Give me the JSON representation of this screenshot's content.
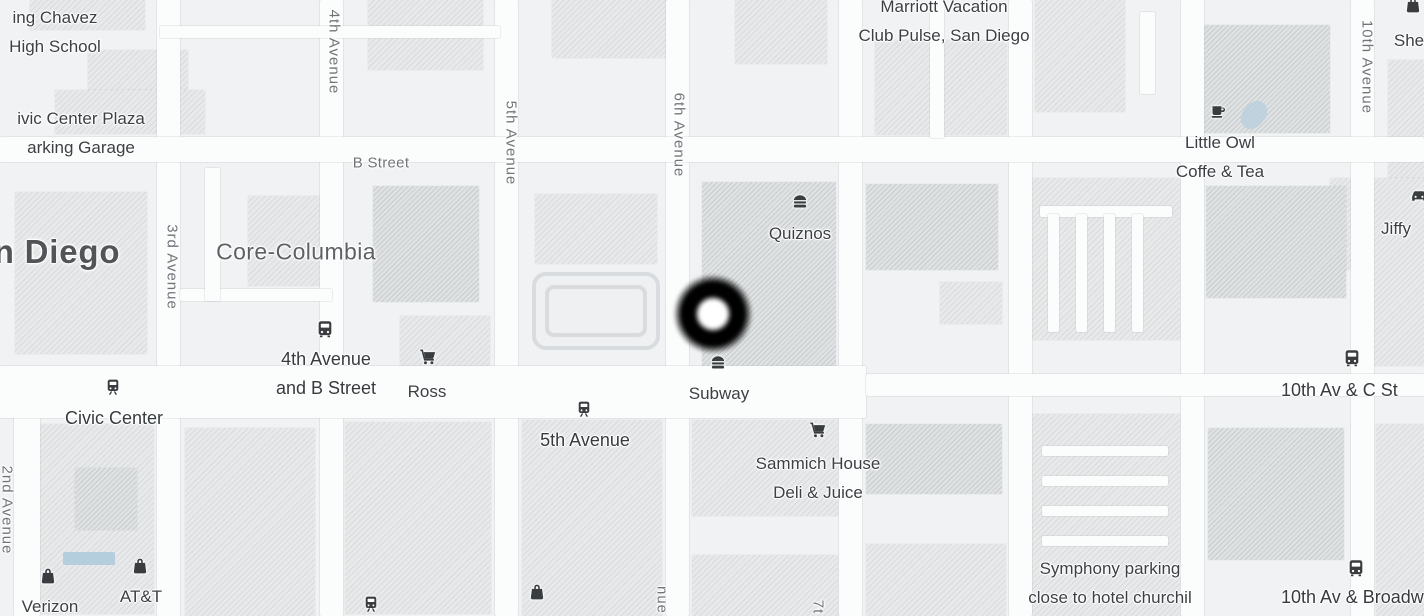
{
  "map": {
    "theme": {
      "land": "#f0f2f3",
      "road": "#fbfcfc",
      "building_light": "#e7e9ea",
      "building_dark": "#dfe2e3",
      "poi_text": "#3c4045",
      "transit_text": "#363b3f",
      "street_text": "#70757a",
      "area_text": "#5d6165",
      "icon": "#3a3d40",
      "water": "#b5cede",
      "marker": "#000000"
    },
    "marker": {
      "x": 713,
      "y": 314
    },
    "street_labels": [
      {
        "text": "B Street",
        "x": 381,
        "y": 163,
        "orientation": "h"
      },
      {
        "text": "2nd Avenue",
        "x": 7,
        "y": 510,
        "orientation": "v"
      },
      {
        "text": "3rd Avenue",
        "x": 172,
        "y": 267,
        "orientation": "v"
      },
      {
        "text": "4th Avenue",
        "x": 334,
        "y": 52,
        "orientation": "v"
      },
      {
        "text": "5th Avenue",
        "x": 511,
        "y": 143,
        "orientation": "v"
      },
      {
        "text": "6th Avenue",
        "x": 679,
        "y": 135,
        "orientation": "v"
      },
      {
        "text": "10th Avenue",
        "x": 1367,
        "y": 67,
        "orientation": "v"
      },
      {
        "text": "nue",
        "x": 662,
        "y": 600,
        "orientation": "v"
      },
      {
        "text": "7t",
        "x": 818,
        "y": 607,
        "orientation": "v"
      }
    ],
    "area_labels": [
      {
        "text": "n Diego",
        "x": 57,
        "y": 252,
        "tier": "city"
      },
      {
        "text": "Core-Columbia",
        "x": 296,
        "y": 252,
        "tier": "district"
      }
    ],
    "pois": [
      {
        "name": "quiznos",
        "icon": "burger-icon",
        "icon_x": 800,
        "icon_y": 201,
        "lines": [
          "Quiznos"
        ],
        "label_x": 800,
        "label_y": 233,
        "anchor": "center"
      },
      {
        "name": "subway",
        "icon": "burger-icon",
        "icon_x": 718,
        "icon_y": 362,
        "lines": [
          "Subway"
        ],
        "label_x": 719,
        "label_y": 393,
        "anchor": "center"
      },
      {
        "name": "sammich-house",
        "icon": "cart-icon",
        "icon_x": 818,
        "icon_y": 430,
        "lines": [
          "Sammich House",
          "Deli & Juice"
        ],
        "label_x": 818,
        "label_y": 463,
        "anchor": "center"
      },
      {
        "name": "ross",
        "icon": "cart-icon",
        "icon_x": 428,
        "icon_y": 357,
        "lines": [
          "Ross"
        ],
        "label_x": 427,
        "label_y": 391,
        "anchor": "center"
      },
      {
        "name": "little-owl",
        "icon": "coffee-icon",
        "icon_x": 1218,
        "icon_y": 112,
        "lines": [
          "Little Owl",
          "Coffe & Tea"
        ],
        "label_x": 1220,
        "label_y": 142,
        "anchor": "center"
      },
      {
        "name": "jiffy",
        "icon": "car-icon",
        "icon_x": 1419,
        "icon_y": 196,
        "lines": [
          "Jiffy"
        ],
        "label_x": 1396,
        "label_y": 228,
        "anchor": "center"
      },
      {
        "name": "verizon",
        "icon": "bag-icon",
        "icon_x": 48,
        "icon_y": 576,
        "lines": [
          "Verizon"
        ],
        "label_x": 50,
        "label_y": 606,
        "anchor": "center"
      },
      {
        "name": "att",
        "icon": "bag-icon",
        "icon_x": 140,
        "icon_y": 566,
        "lines": [
          "AT&T"
        ],
        "label_x": 141,
        "label_y": 596,
        "anchor": "center"
      },
      {
        "name": "she",
        "icon": "bag-icon",
        "icon_x": 1413,
        "icon_y": 5,
        "lines": [
          "She"
        ],
        "label_x": 1409,
        "label_y": 40,
        "anchor": "center"
      },
      {
        "name": "shop-unnamed",
        "icon": "bag-icon",
        "icon_x": 537,
        "icon_y": 592,
        "lines": [],
        "label_x": 537,
        "label_y": 610,
        "anchor": "center"
      },
      {
        "name": "marriott",
        "icon": null,
        "icon_x": 0,
        "icon_y": 0,
        "lines": [
          "Marriott Vacation",
          "Club Pulse, San Diego"
        ],
        "label_x": 944,
        "label_y": 6,
        "anchor": "center"
      },
      {
        "name": "king-chavez",
        "icon": null,
        "icon_x": 0,
        "icon_y": 0,
        "lines": [
          "ing Chavez",
          "High School"
        ],
        "label_x": 55,
        "label_y": 17,
        "anchor": "center"
      },
      {
        "name": "civic-plaza-garage",
        "icon": null,
        "icon_x": 0,
        "icon_y": 0,
        "lines": [
          "ivic Center Plaza",
          "arking Garage"
        ],
        "label_x": 81,
        "label_y": 118,
        "anchor": "center"
      },
      {
        "name": "symphony-parking",
        "icon": null,
        "icon_x": 0,
        "icon_y": 0,
        "lines": [
          "Symphony parking",
          "close to hotel churchil"
        ],
        "label_x": 1110,
        "label_y": 568,
        "anchor": "center"
      }
    ],
    "transit_stops": [
      {
        "name": "civic-center-station",
        "icon": "tram-icon",
        "icon_x": 113,
        "icon_y": 387,
        "lines": [
          "Civic Center"
        ],
        "label_x": 114,
        "label_y": 418,
        "anchor": "center"
      },
      {
        "name": "fifth-avenue-station",
        "icon": "tram-icon",
        "icon_x": 584,
        "icon_y": 409,
        "lines": [
          "5th Avenue"
        ],
        "label_x": 585,
        "label_y": 440,
        "anchor": "center"
      },
      {
        "name": "fourth-and-b-stop",
        "icon": "bus-icon",
        "icon_x": 325,
        "icon_y": 329,
        "lines": [
          "4th Avenue",
          "and B Street"
        ],
        "label_x": 326,
        "label_y": 359,
        "anchor": "center"
      },
      {
        "name": "tenth-and-c-stop",
        "icon": "bus-icon",
        "icon_x": 1352,
        "icon_y": 358,
        "lines": [
          "10th Av & C St"
        ],
        "label_x": 1281,
        "label_y": 390,
        "anchor": "left"
      },
      {
        "name": "tenth-and-broadway-stop",
        "icon": "bus-icon",
        "icon_x": 1356,
        "icon_y": 568,
        "lines": [
          "10th Av & Broadw"
        ],
        "label_x": 1281,
        "label_y": 597,
        "anchor": "left"
      },
      {
        "name": "station-partial",
        "icon": "tram-icon",
        "icon_x": 371,
        "icon_y": 604,
        "lines": [],
        "label_x": 371,
        "label_y": 616,
        "anchor": "center"
      }
    ]
  }
}
